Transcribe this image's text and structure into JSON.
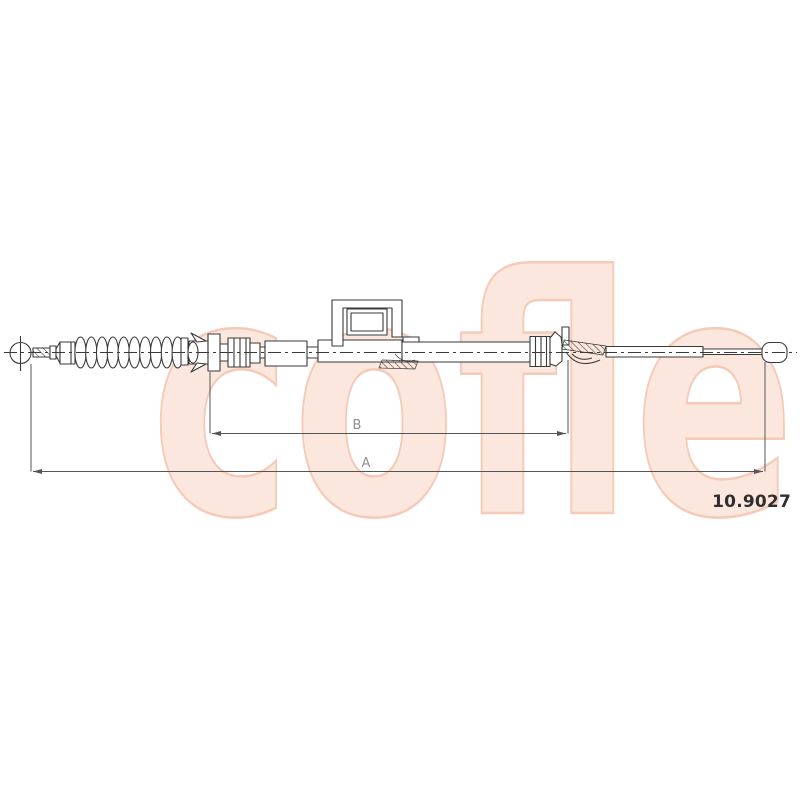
{
  "watermark": {
    "text": "cofle",
    "fill": "#fbe7de",
    "stroke": "#f4c2ae"
  },
  "drawing": {
    "part_number": "10.9027",
    "dim_labels": {
      "a": "A",
      "b": "B"
    }
  },
  "colors": {
    "background": "#ffffff",
    "diagram_line": "#3a3a3a",
    "dimension_line": "#555555",
    "dimension_text": "#8f8f8f",
    "part_number_text": "#2f2f2f"
  }
}
